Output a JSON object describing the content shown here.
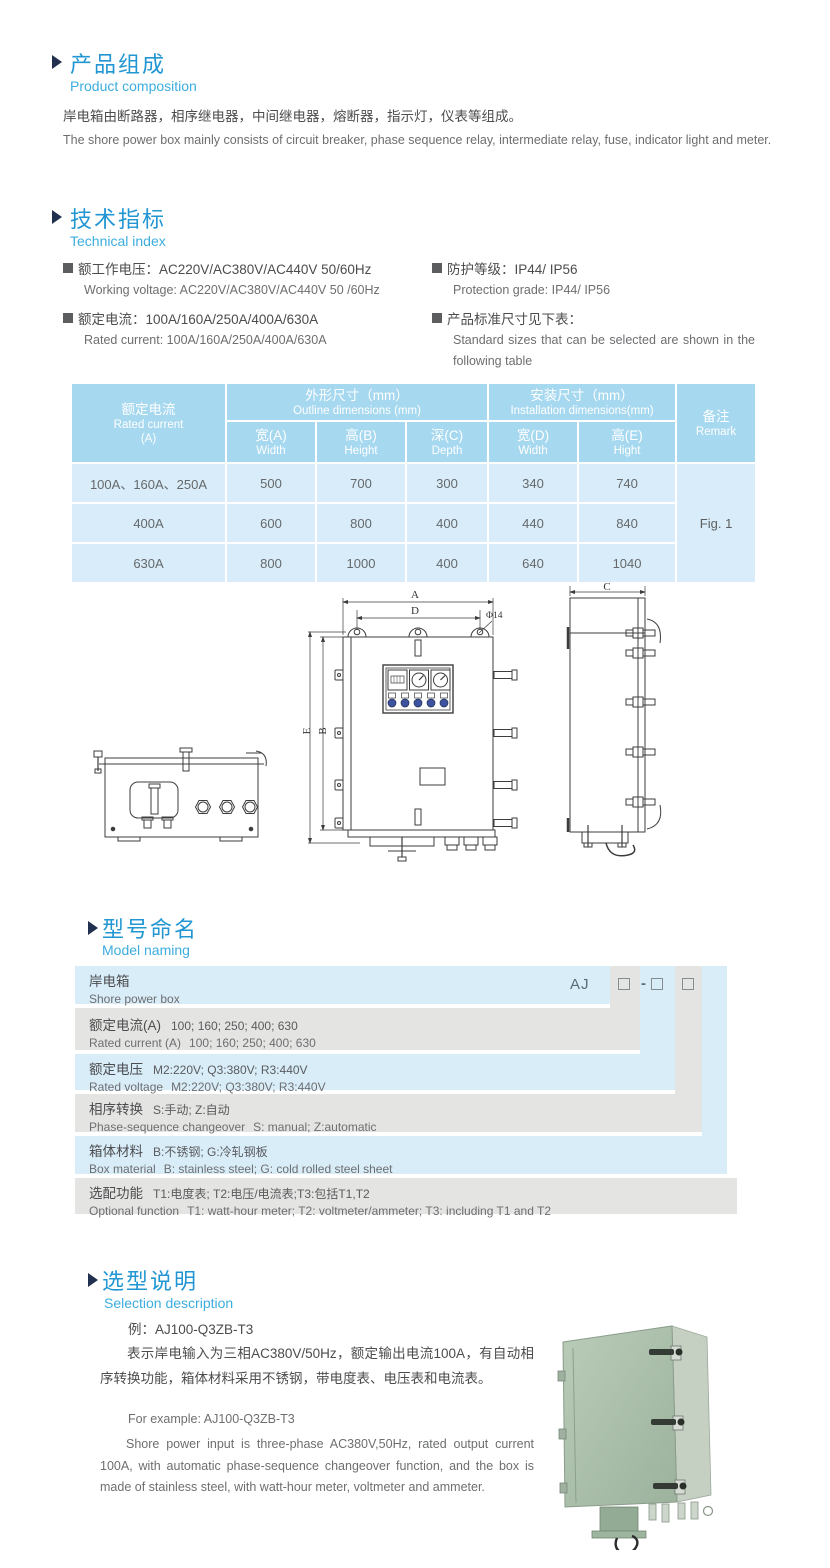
{
  "product_composition": {
    "title_cn": "产品组成",
    "title_en": "Product  composition",
    "body_cn": "岸电箱由断路器，相序继电器，中间继电器，熔断器，指示灯，仪表等组成。",
    "body_en": "The shore power box mainly consists of circuit breaker, phase sequence relay, intermediate relay, fuse, indicator light and meter."
  },
  "technical_index": {
    "title_cn": "技术指标",
    "title_en": "Technical index",
    "specs": [
      {
        "cn": "额工作电压：AC220V/AC380V/AC440V  50/60Hz",
        "en": "Working voltage: AC220V/AC380V/AC440V 50 /60Hz"
      },
      {
        "cn": "额定电流：100A/160A/250A/400A/630A",
        "en": "Rated current: 100A/160A/250A/400A/630A"
      },
      {
        "cn": "防护等级：IP44/ IP56",
        "en": "Protection grade: IP44/ IP56"
      },
      {
        "cn": "产品标准尺寸见下表：",
        "en": "Standard sizes that can be selected are shown in the following table"
      }
    ]
  },
  "dimension_table": {
    "header": {
      "current_cn": "额定电流",
      "current_en": "Rated current",
      "current_unit": "(A)",
      "outline_cn": "外形尺寸（mm）",
      "outline_en": "Outline dimensions (mm)",
      "install_cn": "安装尺寸（mm）",
      "install_en": "Installation dimensions(mm)",
      "remark_cn": "备注",
      "remark_en": "Remark",
      "sub": [
        {
          "cn": "宽(A)",
          "en": "Width"
        },
        {
          "cn": "高(B)",
          "en": "Height"
        },
        {
          "cn": "深(C)",
          "en": "Depth"
        },
        {
          "cn": "宽(D)",
          "en": "Width"
        },
        {
          "cn": "高(E)",
          "en": "Hight"
        }
      ]
    },
    "rows": [
      {
        "current": "100A、160A、250A",
        "w": "500",
        "h": "700",
        "d": "300",
        "iw": "340",
        "ih": "740"
      },
      {
        "current": "400A",
        "w": "600",
        "h": "800",
        "d": "400",
        "iw": "440",
        "ih": "840"
      },
      {
        "current": "630A",
        "w": "800",
        "h": "1000",
        "d": "400",
        "iw": "640",
        "ih": "1040"
      }
    ],
    "remark": "Fig. 1",
    "colors": {
      "header_bg": "#a6d8ef",
      "row_bg": "#d8edf9"
    }
  },
  "technical_drawing": {
    "labels": {
      "width_a": "A",
      "width_d": "D",
      "hole": "Φ14",
      "height_e": "E",
      "height_b": "B",
      "depth_c": "C"
    }
  },
  "model_naming": {
    "title_cn": "型号命名",
    "title_en": "Model naming",
    "code": {
      "prefix": "AJ",
      "dash": "-"
    },
    "rows": [
      {
        "label_cn": "岸电箱",
        "text_cn": "",
        "label_en": "Shore power box",
        "text_en": ""
      },
      {
        "label_cn": "额定电流(A)",
        "text_cn": "100; 160; 250; 400; 630",
        "label_en": "Rated current (A)",
        "text_en": "100; 160; 250; 400; 630"
      },
      {
        "label_cn": "额定电压",
        "text_cn": "M2:220V;  Q3:380V;  R3:440V",
        "label_en": "Rated voltage",
        "text_en": "M2:220V;  Q3:380V;  R3:440V"
      },
      {
        "label_cn": "相序转换",
        "text_cn": "S:手动; Z:自动",
        "label_en": "Phase-sequence changeover",
        "text_en": "S: manual;  Z:automatic"
      },
      {
        "label_cn": "箱体材料",
        "text_cn": "B:不锈钢;  G:冷轧钢板",
        "label_en": "Box material",
        "text_en": "B: stainless steel; G: cold rolled steel sheet"
      },
      {
        "label_cn": "选配功能",
        "text_cn": "T1:电度表;  T2:电压/电流表;T3:包括T1,T2",
        "label_en": "Optional function",
        "text_en": "T1: watt-hour meter; T2: voltmeter/ammeter; T3: including T1 and T2"
      }
    ],
    "colors": {
      "blue": "#d9edf9",
      "gray": "#e4e4e2"
    }
  },
  "selection": {
    "title_cn": "选型说明",
    "title_en": "Selection description",
    "example_cn": "例：AJ100-Q3ZB-T3",
    "body_cn": "表示岸电输入为三相AC380V/50Hz，额定输出电流100A，有自动相序转换功能，箱体材料采用不锈钢，带电度表、电压表和电流表。",
    "example_en": "For example: AJ100-Q3ZB-T3",
    "body_en": "Shore power input is three-phase AC380V,50Hz, rated output current 100A, with automatic phase-sequence changeover function, and the box is made of stainless steel, with watt-hour meter, voltmeter and ammeter."
  }
}
